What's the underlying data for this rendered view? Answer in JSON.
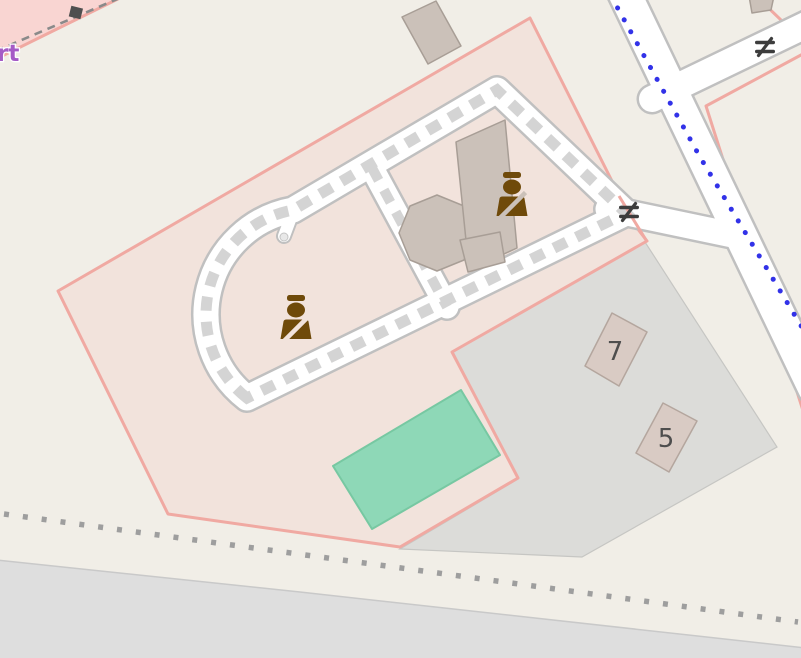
{
  "map": {
    "style": "street-map-tile",
    "houses": [
      {
        "number": "7"
      },
      {
        "number": "5"
      }
    ],
    "labels": {
      "partial_street_label": "rt"
    },
    "icons": {
      "statue": "bust-statue-icon",
      "gate": "gate-icon",
      "marker": "square-marker-icon",
      "footpath": "blue-dotted-path",
      "boundary": "gray-dotted-boundary"
    },
    "colors": {
      "land": "#f1eee7",
      "area_fill": "#f2e3dc",
      "area_border": "#f0a9a2",
      "pink_zone_fill": "#f9d5d2",
      "hatch_fill": "#f7dcd7",
      "hatch_stripe": "#f0b0a8",
      "parking_fill": "#dcdcd9",
      "road_area_fill": "#dedede",
      "pitch_fill": "#8ed8b7",
      "building_fill": "#cbc1b9",
      "house_fill": "#d9cbc4",
      "road_fill": "#ffffff",
      "road_casing": "#c0c0c0",
      "private_access_dash": "#d4d4d4",
      "path_blue": "#3232e8",
      "dots_gray": "#9e9e9e",
      "icon_brown": "#6f4a0a",
      "gate_gray": "#3d3d3d",
      "label_purple": "#a55bc6",
      "number_gray": "#4e4e4e",
      "marker_gray": "#4f4f4f"
    }
  }
}
